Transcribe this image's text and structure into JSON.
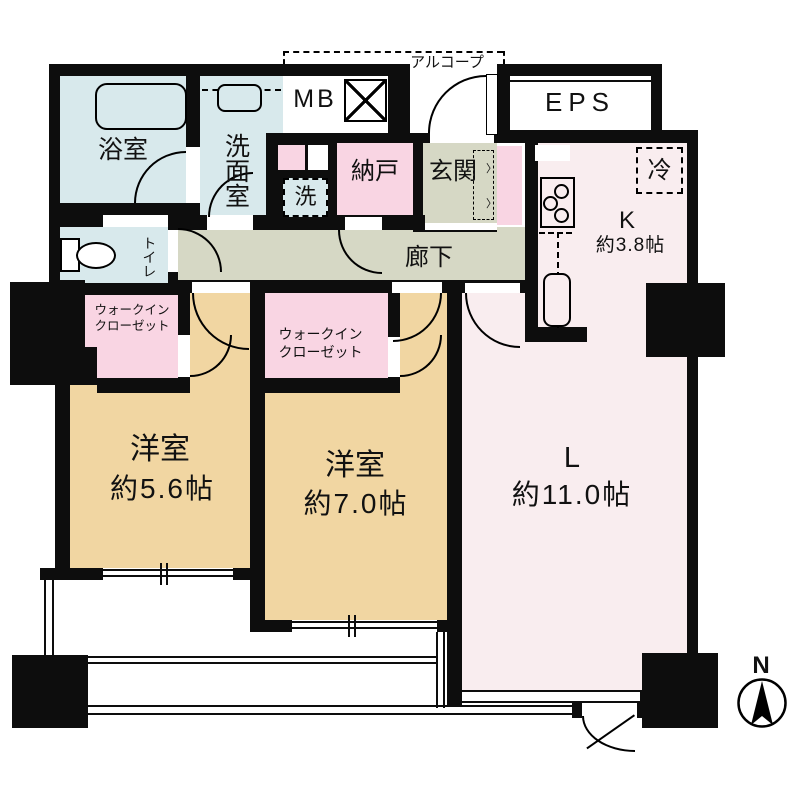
{
  "plan": {
    "bath": "浴室",
    "washroom": "洗面室",
    "toilet": "トイレ",
    "meter_box": "MB",
    "alcove": "アルコープ",
    "eps": "EPS",
    "storage": "納戸",
    "entrance": "玄関",
    "laundry": "洗",
    "fridge": "冷",
    "kitchen_label": "K",
    "kitchen_size": "約3.8帖",
    "corridor": "廊下",
    "wic_line1": "ウォークイン",
    "wic_line2": "クローゼット",
    "bedroom1_label": "洋室",
    "bedroom1_size": "約5.6帖",
    "bedroom2_label": "洋室",
    "bedroom2_size": "約7.0帖",
    "living_label": "L",
    "living_size": "約11.0帖",
    "compass_north": "N"
  },
  "colors": {
    "wall": "#0d0d0d",
    "water_rooms": "#d8e9ec",
    "hall": "#d6d8c5",
    "closet_pink": "#f9d5e3",
    "bedroom_tan": "#f1d6a2",
    "living_pink": "#f9edef"
  }
}
